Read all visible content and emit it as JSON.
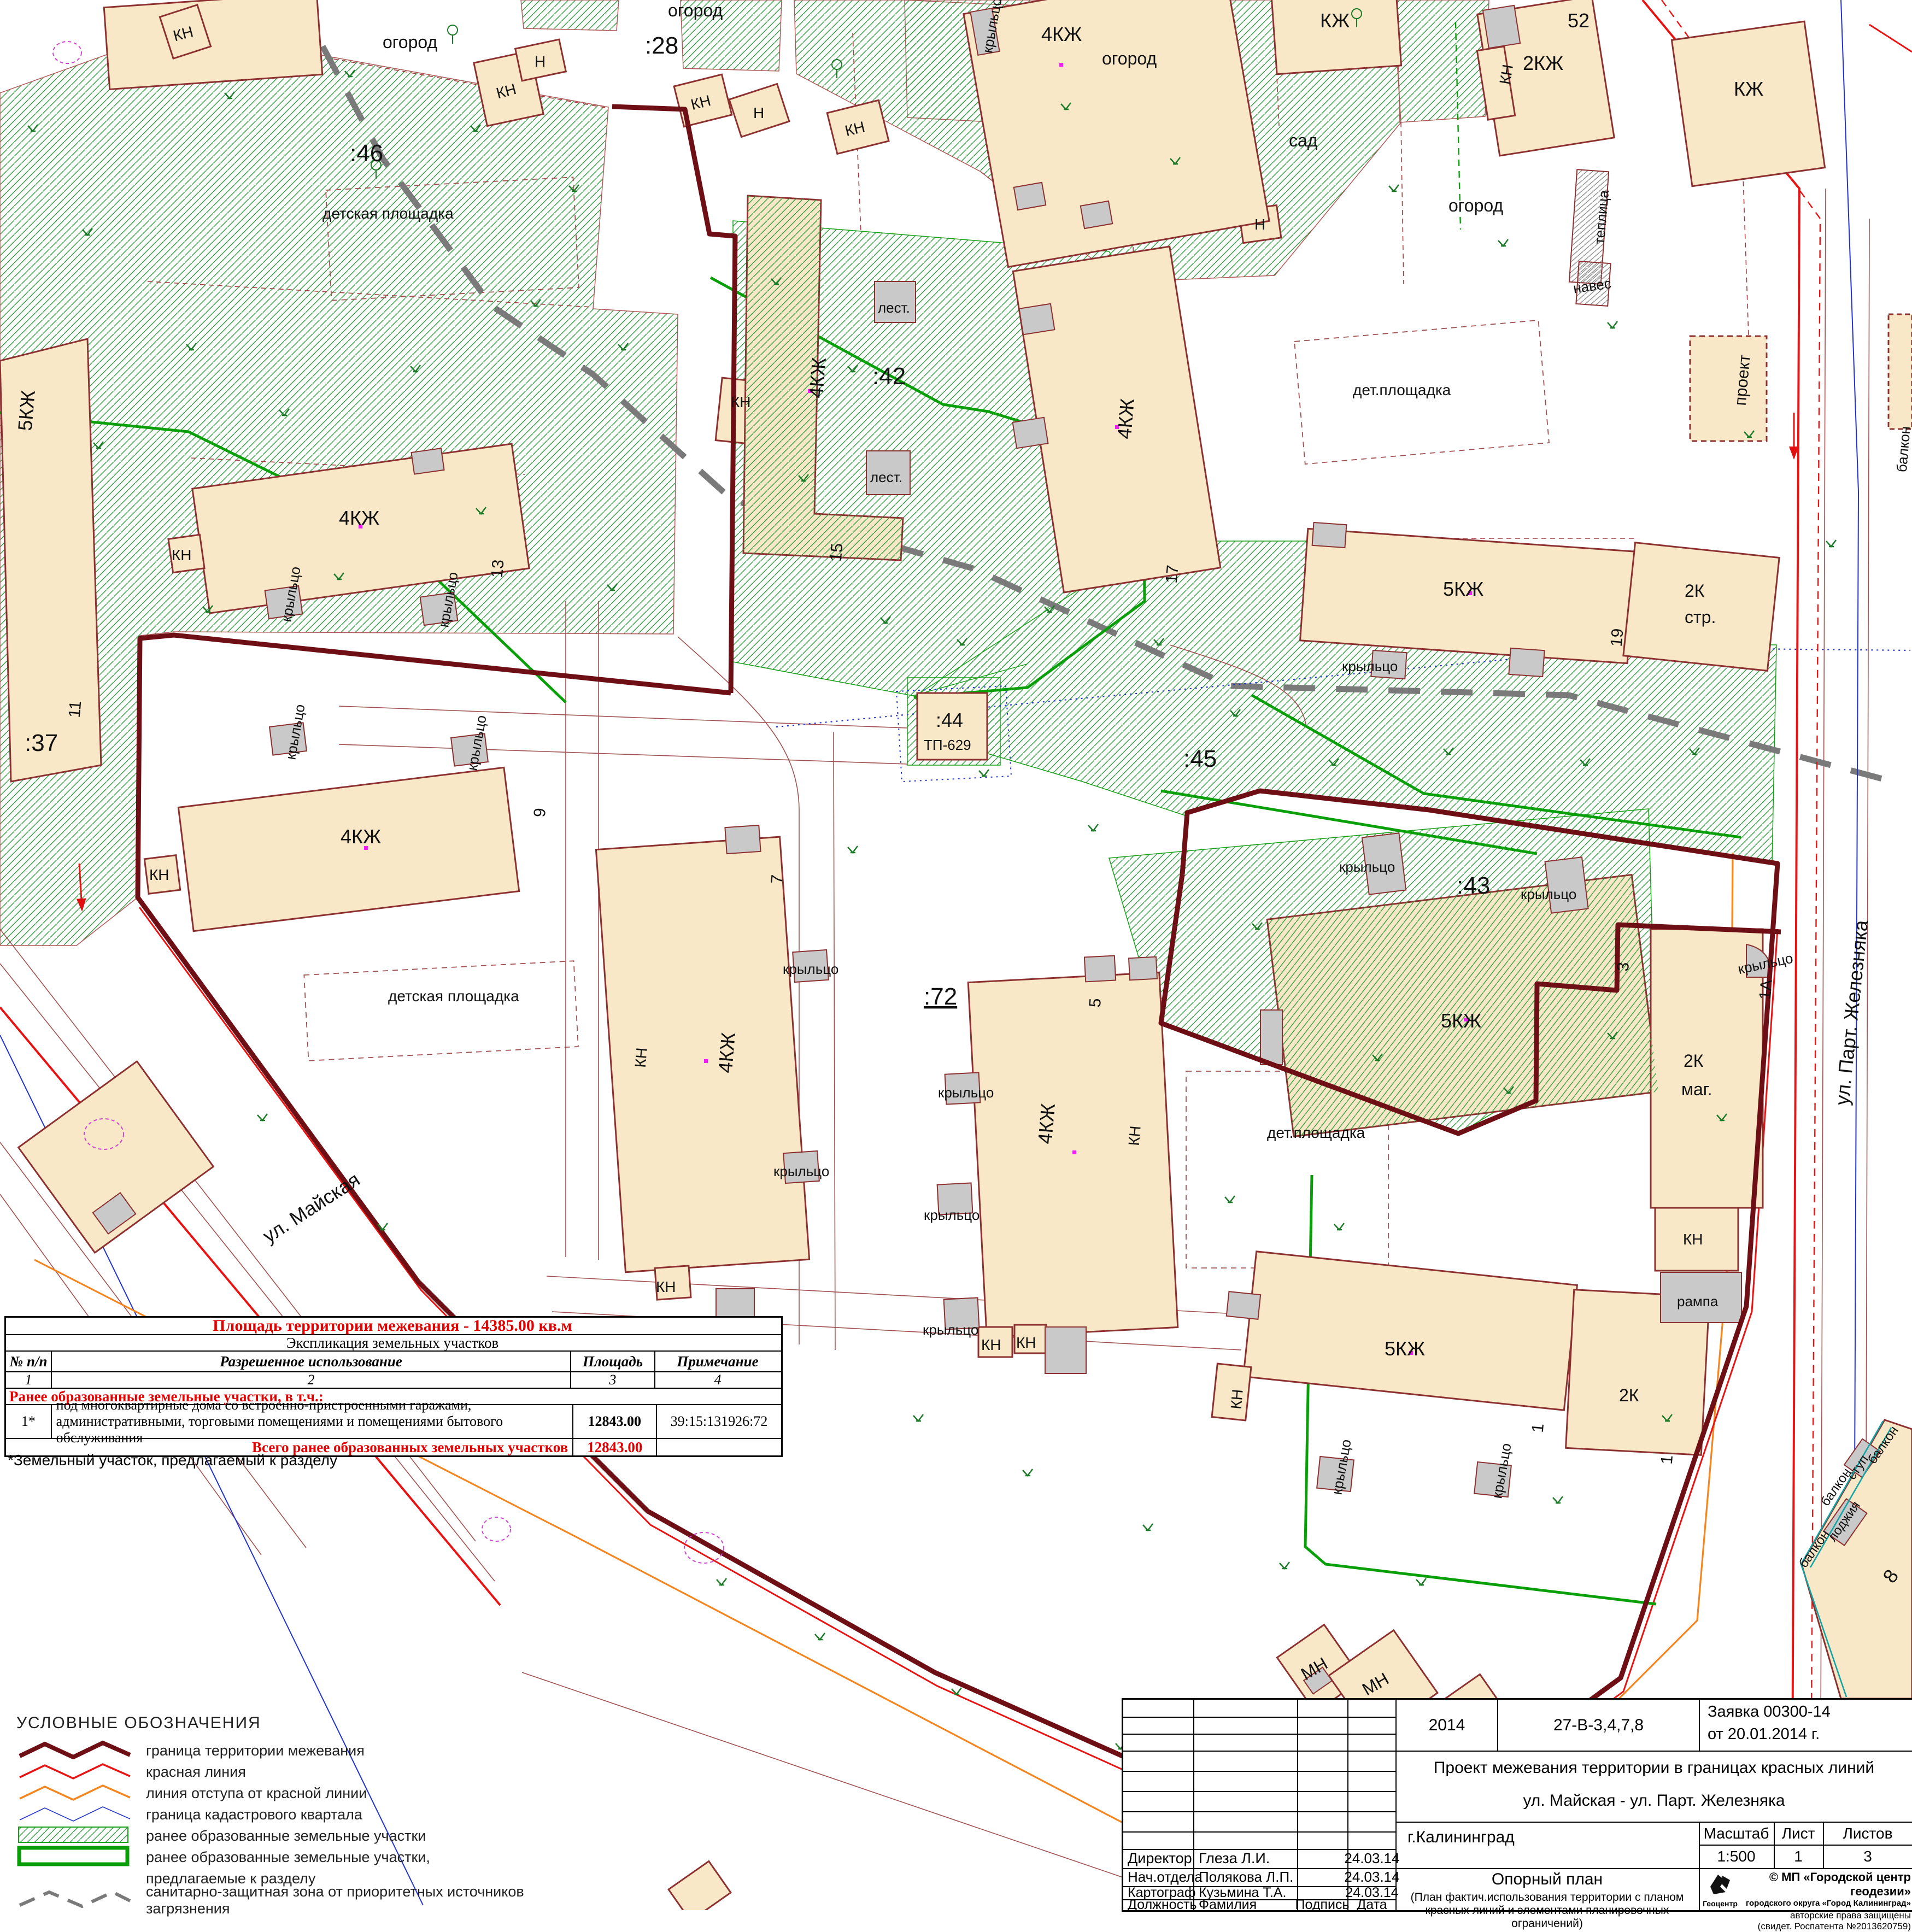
{
  "map": {
    "parcel_labels": {
      "p46": ":46",
      "p28": ":28",
      "p37": ":37",
      "p42": ":42",
      "p43": ":43",
      "p44": ":44",
      "p45": ":45",
      "p72": ":72"
    },
    "building_types": {
      "kzh4": "4КЖ",
      "kzh5": "5КЖ",
      "kzh2": "2КЖ",
      "kzh": "КЖ",
      "k2": "2К",
      "kn": "КН",
      "n": "Н",
      "mn": "МН",
      "tp": "ТП-629",
      "proekt": "проект"
    },
    "annotations": {
      "krylco": "крыльцо",
      "lest": "лест.",
      "str": "стр.",
      "mag": "маг.",
      "rampa": "рампа",
      "teplitsa": "теплица",
      "naves": "навес",
      "balkon": "балкон",
      "lodzhiya": "лоджия",
      "stup": "ступ.",
      "magaz": "магаз",
      "sad": "сад",
      "ogorod": "огород",
      "det_ploshchadka": "детская площадка",
      "det_pl": "дет.площадка"
    },
    "house_numbers": {
      "n52": "52",
      "n15": "15",
      "n17": "17",
      "n19": "19",
      "n13": "13",
      "n11": "11",
      "n9": "9",
      "n7": "7",
      "n5": "5",
      "n3": "3",
      "n1a": "1А",
      "n1": "1",
      "n8": "8"
    },
    "streets": {
      "mayskaya": "ул. Майская",
      "zheleznyaka": "ул. Парт. Железняка"
    }
  },
  "table": {
    "title": "Площадь территории межевания  - 14385.00 кв.м",
    "subtitle": "Экспликация земельных участков",
    "col_num": "№ п/п",
    "col_use": "Разрешенное использование",
    "col_area": "Площадь",
    "col_note": "Примечание",
    "idx1": "1",
    "idx2": "2",
    "idx3": "3",
    "idx4": "4",
    "section": "Ранее образованные земельные участки, в т.ч.:",
    "row_num": "1*",
    "row_use_1": "под многоквартирные дома со встроенно-пристроенными гаражами,",
    "row_use_2": "административными, торговыми помещениями и помещениями бытового обслуживания",
    "row_area": "12843.00",
    "row_note": "39:15:131926:72",
    "total_label": "Всего ранее образованных земельных участков",
    "total_area": "12843.00",
    "footnote": "*Земельный участок, предлагаемый к разделу"
  },
  "legend": {
    "title": "УСЛОВНЫЕ    ОБОЗНАЧЕНИЯ",
    "i1": "граница территории межевания",
    "i2": "красная линия",
    "i3": "линия отступа от красной линии",
    "i4": "граница кадастрового квартала",
    "i5": "ранее образованные земельные участки",
    "i6": "ранее образованные земельные участки,",
    "i7": "предлагаемые к разделу",
    "i8": "санитарно-защитная зона от приоритетных источников загрязнения"
  },
  "titleblock": {
    "year": "2014",
    "code": "27-В-3,4,7,8",
    "request_line1": "Заявка 00300-14",
    "request_line2": "от 20.01.2014 г.",
    "project_line1": "Проект межевания территории в границах красных линий",
    "project_line2": "ул. Майская - ул. Парт. Железняка",
    "city": "г.Калининград",
    "scale_label": "Масштаб",
    "sheet_label": "Лист",
    "sheets_label": "Листов",
    "scale": "1:500",
    "sheet": "1",
    "sheets": "3",
    "rows": [
      {
        "role": "Директор",
        "name": "Глеза Л.И.",
        "date": "24.03.14"
      },
      {
        "role": "Нач.отдела",
        "name": "Полякова Л.П.",
        "date": "24.03.14"
      },
      {
        "role": "Картограф",
        "name": "Кузьмина Т.А.",
        "date": "24.03.14"
      }
    ],
    "footer_role": "Должность",
    "footer_name": "Фамилия",
    "footer_sign": "Подпись",
    "footer_date": "Дата",
    "plan_name": "Опорный план",
    "plan_desc_1": "(План фактич.использования территории с планом",
    "plan_desc_2": "красных линий и элементами планировочных ограничений)",
    "org_line1": "© МП «Городской центр геодезии»",
    "org_line2": "городского округа «Город Калининград»",
    "org_line3": "авторские права защищены",
    "org_line4": "(свидет. Роспатента №2013620759)",
    "logo_caption": "Геоцентр"
  }
}
